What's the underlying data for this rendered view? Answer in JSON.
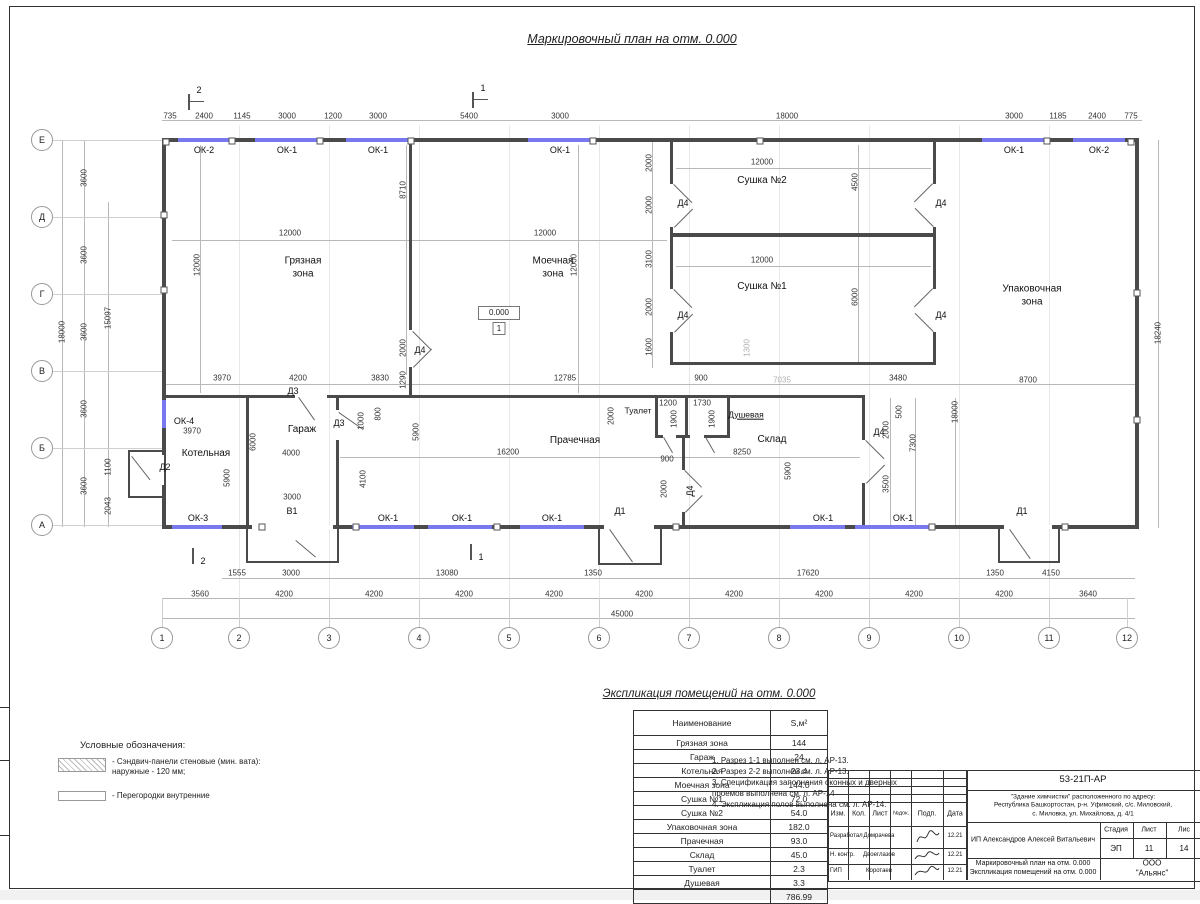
{
  "sheet": {
    "title": "Маркировочный план на отм. 0.000"
  },
  "colors": {
    "wall": "#4a4a4a",
    "window_blue": "#7878ef",
    "dim_text": "#333333",
    "faint_dim": "#b0b0b0"
  },
  "axes_left": [
    "Е",
    "Д",
    "Г",
    "В",
    "Б",
    "А"
  ],
  "axes_bottom": [
    "1",
    "2",
    "3",
    "4",
    "5",
    "6",
    "7",
    "8",
    "9",
    "10",
    "11",
    "12"
  ],
  "sections": {
    "s1": "1",
    "s2": "2"
  },
  "dims_top": [
    "735",
    "2400",
    "1145",
    "3000",
    "1200",
    "3000",
    "5400",
    "3000",
    "18000",
    "3000",
    "1185",
    "2400",
    "775"
  ],
  "dims_left": {
    "spacings": [
      "3600",
      "3600",
      "3600",
      "3600",
      "3600"
    ],
    "total": "18000",
    "inner": "15097",
    "d1100": "1100",
    "d2043": "2043"
  },
  "dims_right": {
    "total": "18240"
  },
  "dims_bottom": {
    "row1": [
      "1555",
      "3000",
      "13080",
      "1350",
      "17620",
      "1350",
      "4150"
    ],
    "row2": [
      "3560",
      "4200",
      "4200",
      "4200",
      "4200",
      "4200",
      "4200",
      "4200",
      "4200",
      "4200",
      "3640"
    ],
    "total": "45000"
  },
  "inner_dims": [
    "12000",
    "12000",
    "8710",
    "12000",
    "12000",
    "2000",
    "12000",
    "4500",
    "2000",
    "3100",
    "12000",
    "6000",
    "2000",
    "1600",
    "2000",
    "1290",
    "3970",
    "4200",
    "3830",
    "12785",
    "900",
    "3480",
    "8700",
    "1300",
    "7035",
    "1200",
    "1730",
    "2000",
    "1900",
    "1900",
    "16200",
    "8250",
    "900",
    "2000",
    "5900",
    "3970",
    "5900",
    "6000",
    "4000",
    "4100",
    "1000",
    "800",
    "3000",
    "5900",
    "500",
    "2000",
    "7300",
    "3500",
    "18000",
    "18240",
    "1100",
    "2043",
    "15097"
  ],
  "plan_labels": [
    "ОК-2",
    "ОК-1",
    "ОК-1",
    "ОК-1",
    "ОК-1",
    "ОК-2",
    "ОК-4",
    "ОК-3",
    "ОК-1",
    "ОК-1",
    "ОК-1",
    "ОК-1",
    "ОК-1",
    "Д4",
    "Д4",
    "Д4",
    "Д4",
    "Д4",
    "Д4",
    "Д4",
    "Д2",
    "Д3",
    "Д3",
    "Д1",
    "Д1",
    "В1"
  ],
  "rooms_plan": [
    "Грязная\nзона",
    "Моечная\nзона",
    "Сушка №2",
    "Сушка №1",
    "Упаковочная\nзона",
    "Котельная",
    "Гараж",
    "Прачечная",
    "Туалет",
    "Душевая",
    "Склад"
  ],
  "elevation": {
    "value": "0.000",
    "floor": "1"
  },
  "legend": {
    "title": "Условные обозначения:",
    "item1": "- Сэндвич-панели стеновые (мин. вата):\nнаружные - 120 мм;",
    "item2": "- Перегородки внутренние"
  },
  "notes": [
    "1. Разрез 1-1 выполнен см. л. АР-13.",
    "2. Разрез 2-2 выполнен см. л. АР-13.",
    "3. Спецификация заполнения оконных и дверных\nпроемов выполнена см. л. АР-14",
    "4. Экспликация полов выполнена см. л. АР-14."
  ],
  "expl": {
    "title": "Экспликация помещений на отм. 0.000",
    "col1": "Наименование",
    "col2": "S,м²",
    "rows": [
      [
        "Грязная зона",
        "144"
      ],
      [
        "Гараж",
        "24"
      ],
      [
        "Котельная",
        "23.4"
      ],
      [
        "Моечная зона",
        "144.0"
      ],
      [
        "Сушка №1",
        "72.0"
      ],
      [
        "Сушка №2",
        "54.0"
      ],
      [
        "Упаковочная зона",
        "182.0"
      ],
      [
        "Прачечная",
        "93.0"
      ],
      [
        "Склад",
        "45.0"
      ],
      [
        "Туалет",
        "2.3"
      ],
      [
        "Душевая",
        "3.3"
      ]
    ],
    "total": "786.99"
  },
  "stamp": {
    "doc_number": "53-21П-АР",
    "address": "\"Здание химчистки\" расположенного по адресу:\nРеспублика Башкортостан, р-н. Уфимский, с/с. Миловский,\nс. Миловка, ул. Михайлова, д. 4/1",
    "header_cells": [
      "Изм.",
      "Кол.",
      "Лист",
      "№док.",
      "Подп.",
      "Дата"
    ],
    "rows": [
      [
        "Разработал",
        "Домрачева",
        "12.21"
      ],
      [
        "Н. контр.",
        "Двоеглазов",
        "12.21"
      ],
      [
        "ГИП",
        "Коротаев",
        "12.21"
      ]
    ],
    "client": "ИП Александров Алексей Витальевич",
    "stage_label": "Стадия",
    "sheet_label": "Лист",
    "sheets_label": "Лис",
    "stage": "ЭП",
    "sheet": "11",
    "sheets": "14",
    "content": "Маркировочный план на отм. 0.000\nЭкспликация помещений на отм. 0.000",
    "org": "ООО \"Альянс\""
  }
}
